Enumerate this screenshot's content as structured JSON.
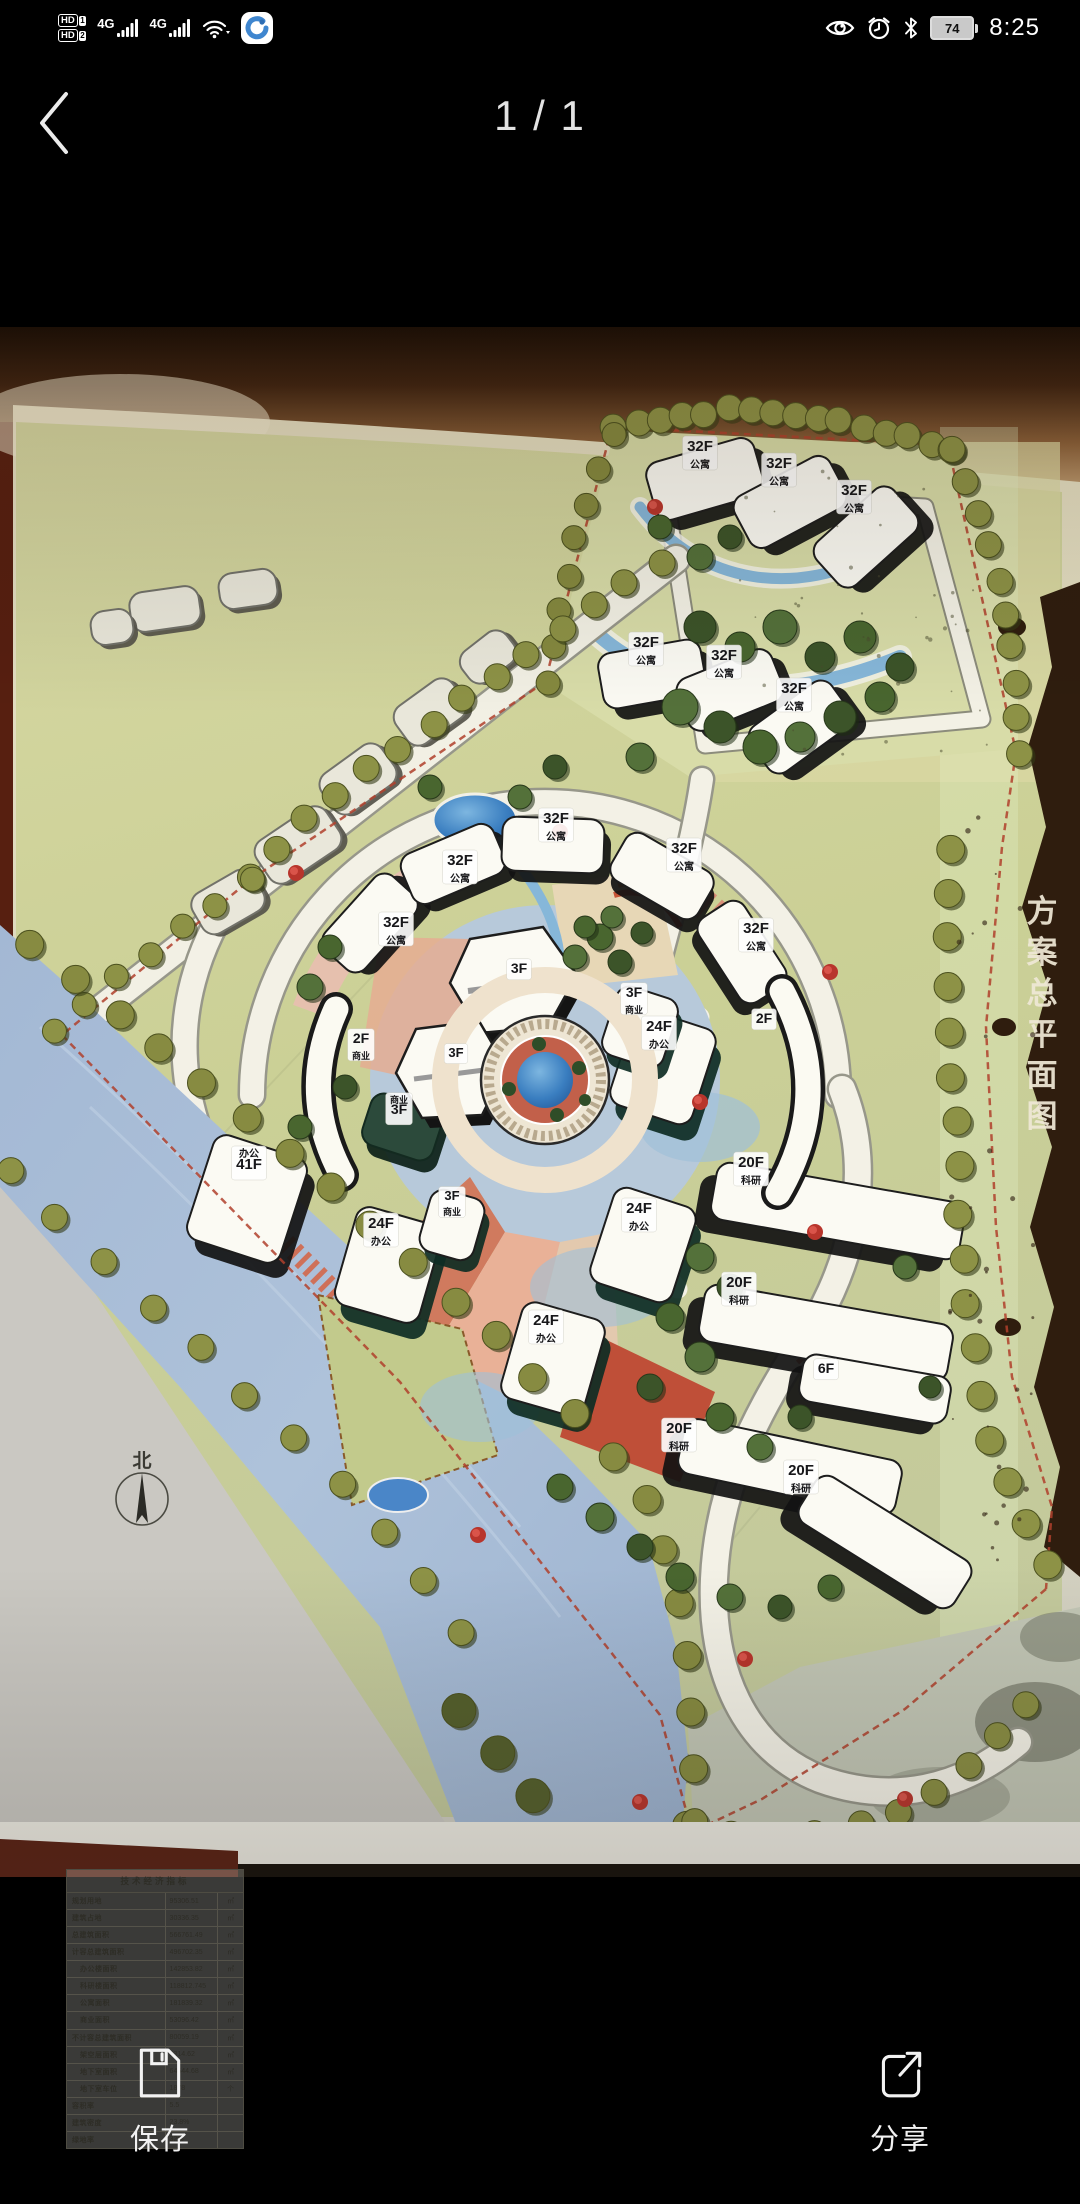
{
  "status_bar": {
    "sim1_badge": "HD",
    "sim1_index": "1",
    "sim2_badge": "HD",
    "sim2_index": "2",
    "network_1": "4G",
    "network_2": "4G",
    "battery_level": "74",
    "time": "8:25"
  },
  "header": {
    "page_indicator": "1 / 1"
  },
  "plan": {
    "side_title": "方案总平面图",
    "side_title_chars": [
      "方",
      "案",
      "总",
      "平",
      "面",
      "图"
    ],
    "compass_label": "北",
    "building_labels": [
      {
        "x": 700,
        "y": 124,
        "lines": [
          [
            "32F",
            15
          ],
          [
            "公寓",
            10
          ]
        ]
      },
      {
        "x": 779,
        "y": 141,
        "lines": [
          [
            "32F",
            15
          ],
          [
            "公寓",
            10
          ]
        ]
      },
      {
        "x": 854,
        "y": 168,
        "lines": [
          [
            "32F",
            15
          ],
          [
            "公寓",
            10
          ]
        ]
      },
      {
        "x": 646,
        "y": 320,
        "lines": [
          [
            "32F",
            15
          ],
          [
            "公寓",
            10
          ]
        ]
      },
      {
        "x": 724,
        "y": 333,
        "lines": [
          [
            "32F",
            15
          ],
          [
            "公寓",
            10
          ]
        ]
      },
      {
        "x": 794,
        "y": 366,
        "lines": [
          [
            "32F",
            15
          ],
          [
            "公寓",
            10
          ]
        ]
      },
      {
        "x": 556,
        "y": 496,
        "lines": [
          [
            "32F",
            15
          ],
          [
            "公寓",
            10
          ]
        ]
      },
      {
        "x": 460,
        "y": 538,
        "lines": [
          [
            "32F",
            15
          ],
          [
            "公寓",
            10
          ]
        ]
      },
      {
        "x": 396,
        "y": 600,
        "lines": [
          [
            "32F",
            15
          ],
          [
            "公寓",
            10
          ]
        ]
      },
      {
        "x": 684,
        "y": 526,
        "lines": [
          [
            "32F",
            15
          ],
          [
            "公寓",
            10
          ]
        ]
      },
      {
        "x": 756,
        "y": 606,
        "lines": [
          [
            "32F",
            15
          ],
          [
            "公寓",
            10
          ]
        ]
      },
      {
        "x": 519,
        "y": 646,
        "lines": [
          [
            "3F",
            14
          ]
        ]
      },
      {
        "x": 456,
        "y": 730,
        "lines": [
          [
            "3F",
            13
          ]
        ]
      },
      {
        "x": 634,
        "y": 670,
        "lines": [
          [
            "3F",
            14
          ],
          [
            "商业",
            9
          ]
        ]
      },
      {
        "x": 659,
        "y": 704,
        "lines": [
          [
            "24F",
            15
          ],
          [
            "办公",
            10
          ]
        ]
      },
      {
        "x": 764,
        "y": 696,
        "lines": [
          [
            "2F",
            14
          ]
        ]
      },
      {
        "x": 361,
        "y": 716,
        "lines": [
          [
            "2F",
            14
          ],
          [
            "商业",
            9
          ]
        ]
      },
      {
        "x": 399,
        "y": 776,
        "lines": [
          [
            "商业",
            9
          ],
          [
            "3F",
            14
          ]
        ]
      },
      {
        "x": 249,
        "y": 830,
        "lines": [
          [
            "办公",
            10
          ],
          [
            "41F",
            15
          ]
        ]
      },
      {
        "x": 639,
        "y": 886,
        "lines": [
          [
            "24F",
            15
          ],
          [
            "办公",
            10
          ]
        ]
      },
      {
        "x": 452,
        "y": 873,
        "lines": [
          [
            "3F",
            13
          ],
          [
            "商业",
            9
          ]
        ]
      },
      {
        "x": 381,
        "y": 901,
        "lines": [
          [
            "24F",
            15
          ],
          [
            "办公",
            10
          ]
        ]
      },
      {
        "x": 546,
        "y": 998,
        "lines": [
          [
            "24F",
            15
          ],
          [
            "办公",
            10
          ]
        ]
      },
      {
        "x": 751,
        "y": 840,
        "lines": [
          [
            "20F",
            15
          ],
          [
            "科研",
            10
          ]
        ]
      },
      {
        "x": 739,
        "y": 960,
        "lines": [
          [
            "20F",
            15
          ],
          [
            "科研",
            10
          ]
        ]
      },
      {
        "x": 679,
        "y": 1106,
        "lines": [
          [
            "20F",
            15
          ],
          [
            "科研",
            10
          ]
        ]
      },
      {
        "x": 801,
        "y": 1148,
        "lines": [
          [
            "20F",
            15
          ],
          [
            "科研",
            10
          ]
        ]
      },
      {
        "x": 826,
        "y": 1046,
        "lines": [
          [
            "6F",
            14
          ]
        ]
      }
    ],
    "table": {
      "title": "技术经济指标",
      "rows": [
        [
          "规划用地",
          "95306.51",
          "㎡",
          0
        ],
        [
          "建筑占地",
          "30336.35",
          "㎡",
          0
        ],
        [
          "总建筑面积",
          "566761.49",
          "㎡",
          0
        ],
        [
          "计容总建筑面积",
          "496702.35",
          "㎡",
          0
        ],
        [
          "办公楼面积",
          "142853.82",
          "㎡",
          1
        ],
        [
          "科研楼面积",
          "118812.745",
          "㎡",
          1
        ],
        [
          "公寓面积",
          "181839.32",
          "㎡",
          1
        ],
        [
          "商业面积",
          "53096.42",
          "㎡",
          1
        ],
        [
          "不计容总建筑面积",
          "80059.19",
          "㎡",
          0
        ],
        [
          "架空层面积",
          "9314.62",
          "㎡",
          1
        ],
        [
          "地下室面积",
          "64544.68",
          "㎡",
          1
        ],
        [
          "地下室车位",
          "1878",
          "个",
          1
        ],
        [
          "容积率",
          "5.5",
          "",
          0
        ],
        [
          "建筑密度",
          "23.8%",
          "",
          0
        ],
        [
          "绿地率",
          "32%",
          "",
          0
        ]
      ]
    },
    "tree_lines": [
      {
        "c": "#8d9246",
        "r": 13,
        "n": 16,
        "p": [
          [
            615,
            103
          ],
          [
            730,
            80
          ],
          [
            850,
            95
          ],
          [
            952,
            122
          ]
        ]
      },
      {
        "c": "#8d9246",
        "r": 13,
        "n": 10,
        "p": [
          [
            952,
            122
          ],
          [
            996,
            230
          ],
          [
            1012,
            330
          ],
          [
            1020,
            424
          ]
        ]
      },
      {
        "c": "#85893f",
        "r": 12,
        "n": 8,
        "p": [
          [
            612,
            106
          ],
          [
            578,
            200
          ],
          [
            556,
            290
          ],
          [
            546,
            356
          ]
        ]
      },
      {
        "c": "#8d9246",
        "r": 13,
        "n": 14,
        "p": [
          [
            660,
            236
          ],
          [
            540,
            316
          ],
          [
            420,
            406
          ],
          [
            318,
            480
          ],
          [
            250,
            552
          ]
        ]
      },
      {
        "c": "#8d9246",
        "r": 12,
        "n": 7,
        "p": [
          [
            250,
            552
          ],
          [
            165,
            616
          ],
          [
            96,
            668
          ],
          [
            54,
            706
          ]
        ]
      },
      {
        "c": "#878b41",
        "r": 14,
        "n": 22,
        "p": [
          [
            32,
            616
          ],
          [
            142,
            706
          ],
          [
            256,
            800
          ],
          [
            370,
            896
          ],
          [
            480,
            996
          ],
          [
            580,
            1090
          ],
          [
            648,
            1176
          ],
          [
            682,
            1282
          ],
          [
            694,
            1392
          ],
          [
            688,
            1496
          ]
        ]
      },
      {
        "c": "#8d9246",
        "r": 13,
        "n": 11,
        "p": [
          [
            10,
            846
          ],
          [
            116,
            946
          ],
          [
            226,
            1046
          ],
          [
            326,
            1140
          ],
          [
            410,
            1236
          ],
          [
            462,
            1306
          ]
        ]
      },
      {
        "c": "#55602c",
        "r": 17,
        "n": 4,
        "p": [
          [
            456,
            1382
          ],
          [
            520,
            1452
          ],
          [
            568,
            1516
          ]
        ]
      },
      {
        "c": "#8d9246",
        "r": 14,
        "n": 17,
        "p": [
          [
            952,
            520
          ],
          [
            946,
            620
          ],
          [
            950,
            720
          ],
          [
            956,
            820
          ],
          [
            962,
            920
          ],
          [
            972,
            1020
          ],
          [
            988,
            1106
          ],
          [
            1016,
            1176
          ],
          [
            1048,
            1236
          ]
        ]
      },
      {
        "c": "#8a8e44",
        "r": 13,
        "n": 10,
        "p": [
          [
            692,
            1496
          ],
          [
            762,
            1512
          ],
          [
            842,
            1504
          ],
          [
            916,
            1478
          ],
          [
            976,
            1432
          ],
          [
            1026,
            1376
          ]
        ]
      }
    ],
    "tree_clumps": [
      [
        700,
        300,
        16
      ],
      [
        740,
        320,
        15
      ],
      [
        780,
        300,
        17
      ],
      [
        820,
        330,
        15
      ],
      [
        860,
        310,
        16
      ],
      [
        680,
        380,
        18
      ],
      [
        720,
        400,
        16
      ],
      [
        760,
        420,
        17
      ],
      [
        800,
        410,
        15
      ],
      [
        840,
        390,
        16
      ],
      [
        880,
        370,
        15
      ],
      [
        640,
        430,
        14
      ],
      [
        900,
        340,
        14
      ],
      [
        660,
        200,
        12
      ],
      [
        700,
        230,
        13
      ],
      [
        730,
        210,
        12
      ],
      [
        600,
        610,
        13
      ],
      [
        575,
        630,
        12
      ],
      [
        620,
        635,
        12
      ],
      [
        585,
        600,
        11
      ],
      [
        612,
        590,
        11
      ],
      [
        642,
        606,
        11
      ],
      [
        330,
        620,
        12
      ],
      [
        310,
        660,
        13
      ],
      [
        345,
        760,
        12
      ],
      [
        300,
        800,
        12
      ],
      [
        700,
        930,
        14
      ],
      [
        730,
        960,
        13
      ],
      [
        670,
        990,
        14
      ],
      [
        700,
        1030,
        15
      ],
      [
        650,
        1060,
        13
      ],
      [
        720,
        1090,
        14
      ],
      [
        760,
        1120,
        13
      ],
      [
        800,
        1090,
        12
      ],
      [
        560,
        1160,
        13
      ],
      [
        600,
        1190,
        14
      ],
      [
        640,
        1220,
        13
      ],
      [
        680,
        1250,
        14
      ],
      [
        730,
        1270,
        13
      ],
      [
        780,
        1280,
        12
      ],
      [
        830,
        1260,
        12
      ],
      [
        905,
        940,
        12
      ],
      [
        930,
        1060,
        11
      ],
      [
        430,
        460,
        12
      ],
      [
        520,
        470,
        12
      ],
      [
        555,
        440,
        12
      ]
    ],
    "red_trees": [
      [
        655,
        180
      ],
      [
        830,
        645
      ],
      [
        700,
        775
      ],
      [
        478,
        1208
      ],
      [
        745,
        1332
      ],
      [
        640,
        1475
      ],
      [
        905,
        1472
      ],
      [
        560,
        505
      ],
      [
        296,
        546
      ],
      [
        815,
        905
      ]
    ]
  },
  "bottom_bar": {
    "save_label": "保存",
    "share_label": "分享"
  }
}
